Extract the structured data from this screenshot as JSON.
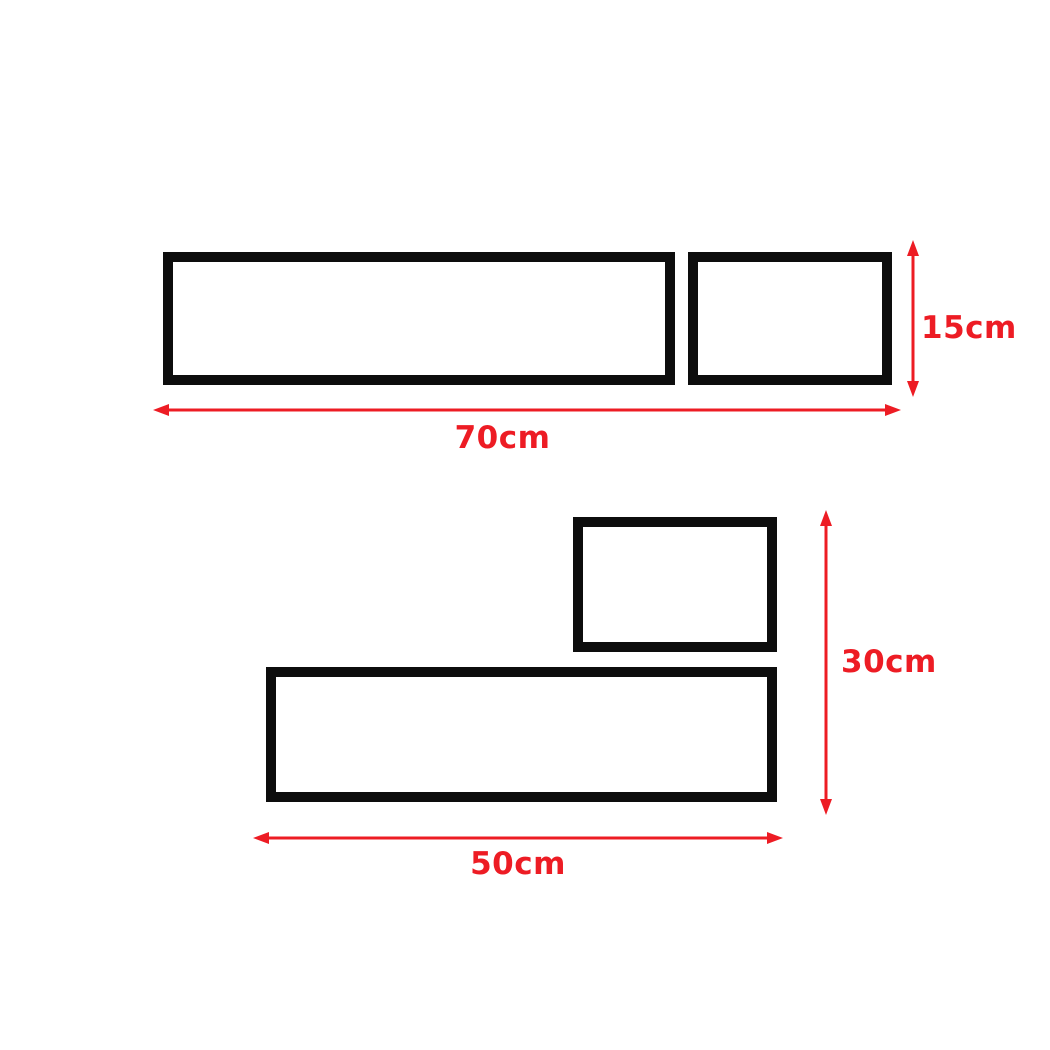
{
  "diagram": {
    "type": "product-dimensions",
    "background_color": "#ffffff",
    "shape_border_color": "#0d0d0d",
    "dimension_color": "#ed1c24",
    "top_group": {
      "shapes": [
        "long shelf",
        "short shelf"
      ],
      "height_label": "15cm",
      "width_label": "70cm"
    },
    "bottom_group": {
      "shapes": [
        "short shelf",
        "long shelf"
      ],
      "height_label": "30cm",
      "width_label": "50cm"
    }
  }
}
